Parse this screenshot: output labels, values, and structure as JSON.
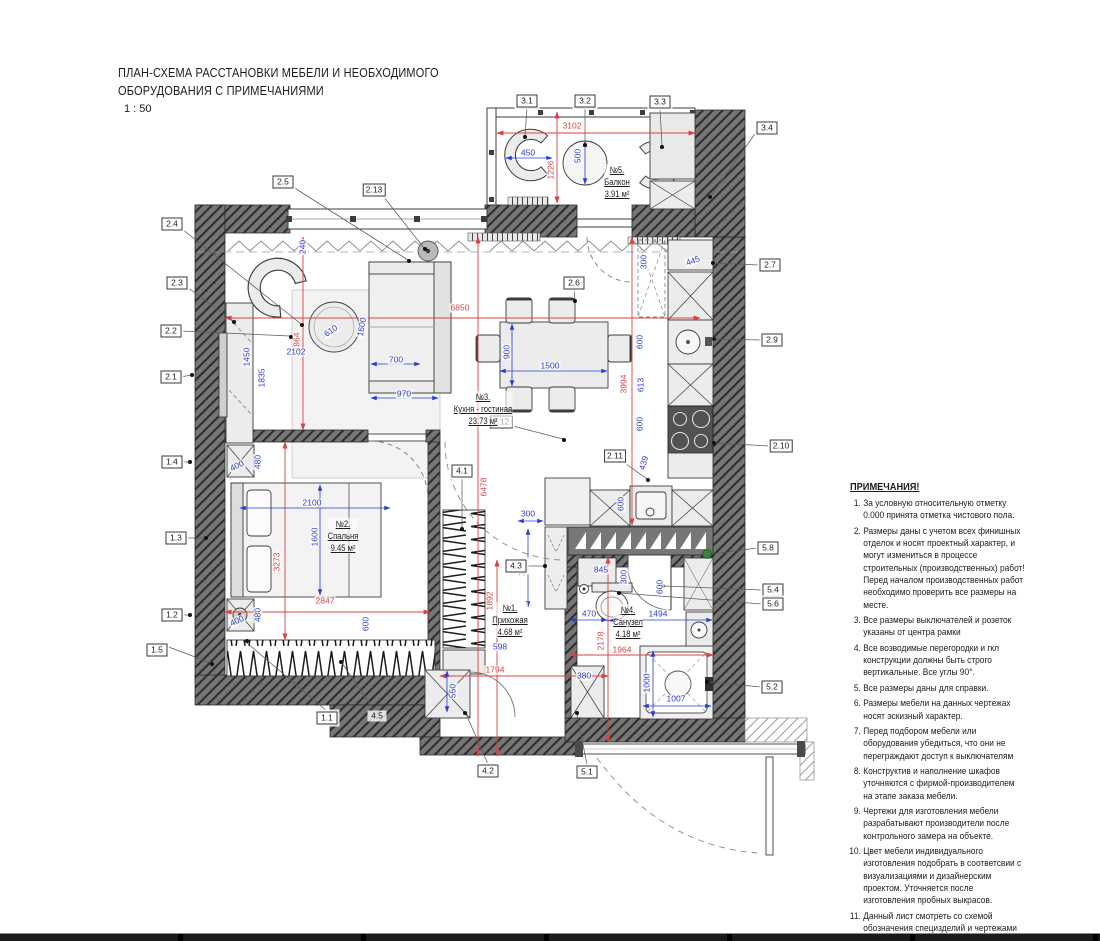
{
  "title": {
    "line1": "ПЛАН-СХЕМА РАССТАНОВКИ МЕБЕЛИ И НЕОБХОДИМОГО",
    "line2": "ОБОРУДОВАНИЯ С ПРИМЕЧАНИЯМИ",
    "scale": "1 : 50"
  },
  "notes": {
    "heading": "ПРИМЕЧАНИЯ!",
    "items": [
      "За условную относительную отметку 0.000 принята отметка чистового пола.",
      "Размеры даны с учетом всех финишных отделок и носят проектный характер, и могут измениться в процессе строительных (производственных) работ! Перед началом производственных работ необходимо проверить все размеры на месте.",
      "Все размеры выключателей и розеток указаны от центра рамки",
      "Все возводимые перегородки и гкл конструкции должны быть строго вертикальные. Все углы 90°.",
      "Все размеры даны для справки.",
      "Размеры мебели на данных чертежах носят эскизный характер.",
      "Перед подбором мебели или оборудования убедиться, что они не переграждают доступ к выключателям",
      "Конструктив и наполнение шкафов уточняются с фирмой-производителем на этапе заказа мебели.",
      "Чертежи для изготовления мебели разрабатывают производители после контрольного замера на объекте.",
      "Цвет мебели индивидуального изготовления подобрать в соответсвии с визуализациями и дизайнерским проектом. Уточняется после изготовления пробных выкрасов.",
      "Данный лист смотреть со схемой обозначения специзделий и чертежами индивидуального изготовления мебели, а также с листами спецификаций мебели."
    ]
  },
  "rooms": [
    {
      "number": "№5.",
      "name": "Балкон",
      "area": "3.91 м²",
      "x": 617,
      "y": 164
    },
    {
      "number": "№3.",
      "name": "Кухня - гостиная",
      "area": "23.73 м²",
      "x": 483,
      "y": 391
    },
    {
      "number": "№2.",
      "name": "Спальня",
      "area": "9.45 м²",
      "x": 343,
      "y": 518
    },
    {
      "number": "№1.",
      "name": "Прихожая",
      "area": "4.68 м²",
      "x": 510,
      "y": 602
    },
    {
      "number": "№4.",
      "name": "Санузел",
      "area": "4.18 м²",
      "x": 628,
      "y": 604
    }
  ],
  "markers": [
    {
      "label": "3.1",
      "x": 527,
      "y": 101
    },
    {
      "label": "3.2",
      "x": 585,
      "y": 101
    },
    {
      "label": "3.3",
      "x": 660,
      "y": 102
    },
    {
      "label": "3.4",
      "x": 767,
      "y": 128
    },
    {
      "label": "2.5",
      "x": 283,
      "y": 182
    },
    {
      "label": "2.13",
      "x": 374,
      "y": 190
    },
    {
      "label": "2.4",
      "x": 172,
      "y": 224
    },
    {
      "label": "2.3",
      "x": 177,
      "y": 283
    },
    {
      "label": "2.2",
      "x": 171,
      "y": 331
    },
    {
      "label": "2.1",
      "x": 171,
      "y": 377
    },
    {
      "label": "1.4",
      "x": 172,
      "y": 462
    },
    {
      "label": "1.3",
      "x": 176,
      "y": 538
    },
    {
      "label": "1.2",
      "x": 172,
      "y": 615
    },
    {
      "label": "1.5",
      "x": 157,
      "y": 650
    },
    {
      "label": "1.1",
      "x": 327,
      "y": 718
    },
    {
      "label": "4.5",
      "x": 377,
      "y": 716,
      "nobox": true
    },
    {
      "label": "4.2",
      "x": 488,
      "y": 771
    },
    {
      "label": "5.1",
      "x": 587,
      "y": 772
    },
    {
      "label": "4.1",
      "x": 462,
      "y": 471
    },
    {
      "label": "4.3",
      "x": 516,
      "y": 566
    },
    {
      "label": "2.6",
      "x": 574,
      "y": 283
    },
    {
      "label": "2.11",
      "x": 615,
      "y": 456
    },
    {
      "label": "2.12",
      "x": 501,
      "y": 422
    },
    {
      "label": "2.7",
      "x": 770,
      "y": 265
    },
    {
      "label": "2.9",
      "x": 772,
      "y": 340
    },
    {
      "label": "2.10",
      "x": 781,
      "y": 446
    },
    {
      "label": "5.8",
      "x": 768,
      "y": 548
    },
    {
      "label": "5.4",
      "x": 773,
      "y": 590
    },
    {
      "label": "5.6",
      "x": 773,
      "y": 604
    },
    {
      "label": "5.2",
      "x": 772,
      "y": 687
    }
  ],
  "dimensions": [
    {
      "v": "3102",
      "x": 572,
      "y": 126,
      "c": "r"
    },
    {
      "v": "1226",
      "x": 551,
      "y": 170,
      "rot": -90,
      "c": "r"
    },
    {
      "v": "6850",
      "x": 460,
      "y": 308,
      "c": "r"
    },
    {
      "v": "2864",
      "x": 297,
      "y": 342,
      "rot": -90,
      "c": "r"
    },
    {
      "v": "3994",
      "x": 624,
      "y": 384,
      "rot": -90,
      "c": "r"
    },
    {
      "v": "6478",
      "x": 484,
      "y": 487,
      "rot": -90,
      "c": "r"
    },
    {
      "v": "3273",
      "x": 277,
      "y": 562,
      "rot": -90,
      "c": "r"
    },
    {
      "v": "2847",
      "x": 325,
      "y": 601,
      "c": "r"
    },
    {
      "v": "1892",
      "x": 490,
      "y": 601,
      "rot": -90,
      "c": "r"
    },
    {
      "v": "2178",
      "x": 601,
      "y": 641,
      "rot": -90,
      "c": "r"
    },
    {
      "v": "1964",
      "x": 622,
      "y": 650,
      "c": "r"
    },
    {
      "v": "1794",
      "x": 495,
      "y": 670,
      "c": "r"
    },
    {
      "v": "450",
      "x": 528,
      "y": 153,
      "c": "b"
    },
    {
      "v": "500",
      "x": 578,
      "y": 156,
      "rot": -90,
      "c": "b"
    },
    {
      "v": "240",
      "x": 303,
      "y": 247,
      "rot": -90,
      "c": "b"
    },
    {
      "v": "2102",
      "x": 296,
      "y": 352,
      "c": "b"
    },
    {
      "v": "610",
      "x": 331,
      "y": 331,
      "rot": -35,
      "c": "b"
    },
    {
      "v": "1600",
      "x": 362,
      "y": 327,
      "rot": -80,
      "c": "b"
    },
    {
      "v": "700",
      "x": 396,
      "y": 360,
      "c": "b"
    },
    {
      "v": "970",
      "x": 404,
      "y": 394,
      "c": "b"
    },
    {
      "v": "1450",
      "x": 247,
      "y": 357,
      "rot": -90,
      "c": "b"
    },
    {
      "v": "1835",
      "x": 262,
      "y": 378,
      "rot": -90,
      "c": "b"
    },
    {
      "v": "900",
      "x": 507,
      "y": 352,
      "rot": -90,
      "c": "b"
    },
    {
      "v": "1500",
      "x": 550,
      "y": 366,
      "c": "b"
    },
    {
      "v": "300",
      "x": 644,
      "y": 262,
      "rot": -90,
      "c": "b"
    },
    {
      "v": "445",
      "x": 693,
      "y": 261,
      "rot": -20,
      "c": "b"
    },
    {
      "v": "600",
      "x": 640,
      "y": 342,
      "rot": -90,
      "c": "b"
    },
    {
      "v": "613",
      "x": 641,
      "y": 385,
      "rot": -90,
      "c": "b"
    },
    {
      "v": "600",
      "x": 640,
      "y": 424,
      "rot": -90,
      "c": "b"
    },
    {
      "v": "439",
      "x": 644,
      "y": 463,
      "rot": -75,
      "c": "b"
    },
    {
      "v": "600",
      "x": 621,
      "y": 504,
      "rot": -90,
      "c": "b"
    },
    {
      "v": "2100",
      "x": 312,
      "y": 503,
      "c": "b"
    },
    {
      "v": "1600",
      "x": 315,
      "y": 537,
      "rot": -90,
      "c": "b"
    },
    {
      "v": "400",
      "x": 237,
      "y": 466,
      "rot": -25,
      "c": "b"
    },
    {
      "v": "480",
      "x": 258,
      "y": 462,
      "rot": -90,
      "c": "b"
    },
    {
      "v": "400",
      "x": 237,
      "y": 621,
      "rot": -25,
      "c": "b"
    },
    {
      "v": "480",
      "x": 258,
      "y": 615,
      "rot": -90,
      "c": "b"
    },
    {
      "v": "600",
      "x": 366,
      "y": 624,
      "rot": -90,
      "c": "b"
    },
    {
      "v": "300",
      "x": 528,
      "y": 514,
      "c": "b"
    },
    {
      "v": "1178",
      "x": 522,
      "y": 567,
      "rot": -90,
      "c": "b"
    },
    {
      "v": "598",
      "x": 500,
      "y": 647,
      "c": "b"
    },
    {
      "v": "470",
      "x": 589,
      "y": 614,
      "c": "b"
    },
    {
      "v": "1494",
      "x": 658,
      "y": 614,
      "c": "b"
    },
    {
      "v": "845",
      "x": 601,
      "y": 570,
      "c": "b"
    },
    {
      "v": "300",
      "x": 624,
      "y": 577,
      "rot": -90,
      "c": "b"
    },
    {
      "v": "600",
      "x": 660,
      "y": 587,
      "rot": -90,
      "c": "b"
    },
    {
      "v": "1000",
      "x": 647,
      "y": 683,
      "rot": -90,
      "c": "b"
    },
    {
      "v": "1007",
      "x": 676,
      "y": 699,
      "c": "b"
    },
    {
      "v": "380",
      "x": 584,
      "y": 676,
      "c": "b"
    },
    {
      "v": "550",
      "x": 453,
      "y": 691,
      "rot": -90,
      "c": "b"
    }
  ],
  "colors": {
    "dimension_red": "#d84343",
    "dimension_blue": "#2c3bd4",
    "wall_gray": "#767676",
    "marker_green": "#37823c"
  }
}
